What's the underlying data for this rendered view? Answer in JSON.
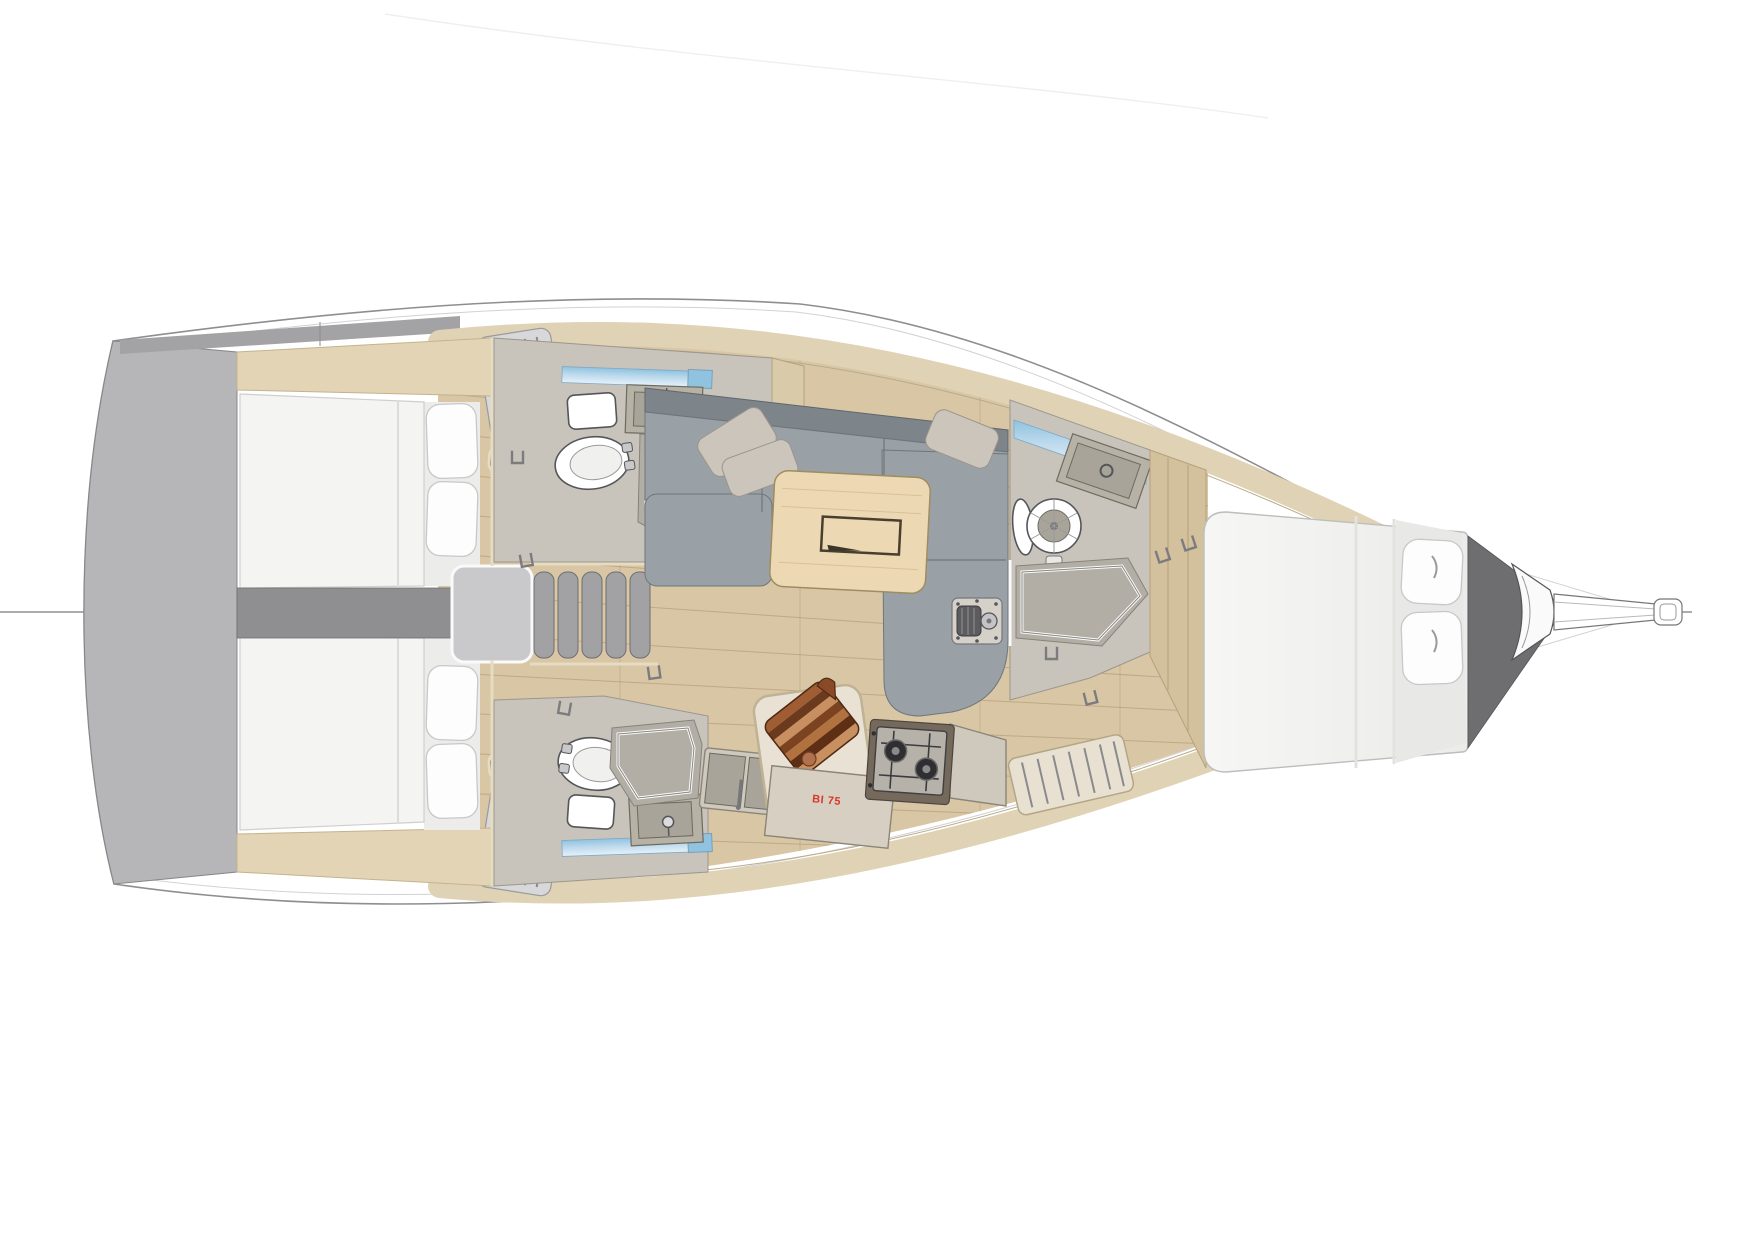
{
  "document": {
    "type": "yacht-interior-floorplan",
    "view": "top-down-render",
    "bow_direction": "right",
    "stern_direction": "left",
    "background": "#ffffff"
  },
  "labels": {
    "fridge_model": "BI 75"
  },
  "colors": {
    "hull_fill": "#ffffff",
    "hull_line": "#8e8e90",
    "inner_line": "#d2d2d4",
    "transom_gray": "#b6b6b8",
    "corridor_gray": "#8f8f91",
    "deck_trim_beige": "#e0d2b4",
    "wall_cream": "#e6dcc2",
    "wood_floor": "#d8c6a5",
    "plank_line": "#8c683c",
    "mattress_white": "#f4f4f2",
    "pillow_white": "#fdfdfd",
    "sofa_seat_gray": "#9aa1a6",
    "sofa_back_gray": "#7d848a",
    "sofa_pillow_beige": "#cbc5bb",
    "table_wood": "#ecd9b4",
    "head_floor_gray": "#c8c4bb",
    "shower_gray": "#b2aea6",
    "fixture_white": "#ffffff",
    "window_blue": "#a9cfe6",
    "cabinet_taupe": "#b7b2a6",
    "counter_beige": "#cfc9bd",
    "stove_body": "#75695c",
    "burner_dark": "#2f2f31",
    "board_dark_brown": "#6b3a1d",
    "board_mid_brown": "#a05c32",
    "board_light_brown": "#c88f60",
    "accent_red": "#d9372b",
    "metal_gray": "#8b8b8d",
    "bow_wedge_dark": "#6e6e70",
    "stairs_gray": "#a2a2a4"
  },
  "areas": [
    {
      "id": "transom",
      "label": "stern-platform"
    },
    {
      "id": "aft-cabin-port",
      "label": "aft-double-cabin"
    },
    {
      "id": "aft-cabin-starboard",
      "label": "aft-double-cabin"
    },
    {
      "id": "companionway",
      "label": "companionway-stairs"
    },
    {
      "id": "head-aft-port",
      "label": "aft-head-toilet-shower"
    },
    {
      "id": "head-aft-starboard",
      "label": "aft-head-toilet-shower"
    },
    {
      "id": "saloon",
      "label": "saloon-l-sofa-and-table"
    },
    {
      "id": "galley",
      "label": "galley-sink-fridge-stove"
    },
    {
      "id": "head-forward",
      "label": "forward-head-toilet-shower"
    },
    {
      "id": "forward-cabin",
      "label": "owner-cabin-island-berth"
    },
    {
      "id": "bow",
      "label": "anchor-locker-bowsprit"
    }
  ],
  "fixtures": [
    "double-berth-aft-port",
    "double-berth-aft-starboard",
    "island-berth-forward",
    "pillows-x7",
    "toilet-x3",
    "sink-x4",
    "shower-x3",
    "l-shaped-sofa",
    "saloon-table",
    "wooden-cutting-board",
    "two-burner-stove",
    "refrigerator",
    "mast-step-fitting",
    "companionway-stairs-5-treads",
    "cockpit-locker-slats-x2",
    "bowsprit-anchor-roller"
  ]
}
